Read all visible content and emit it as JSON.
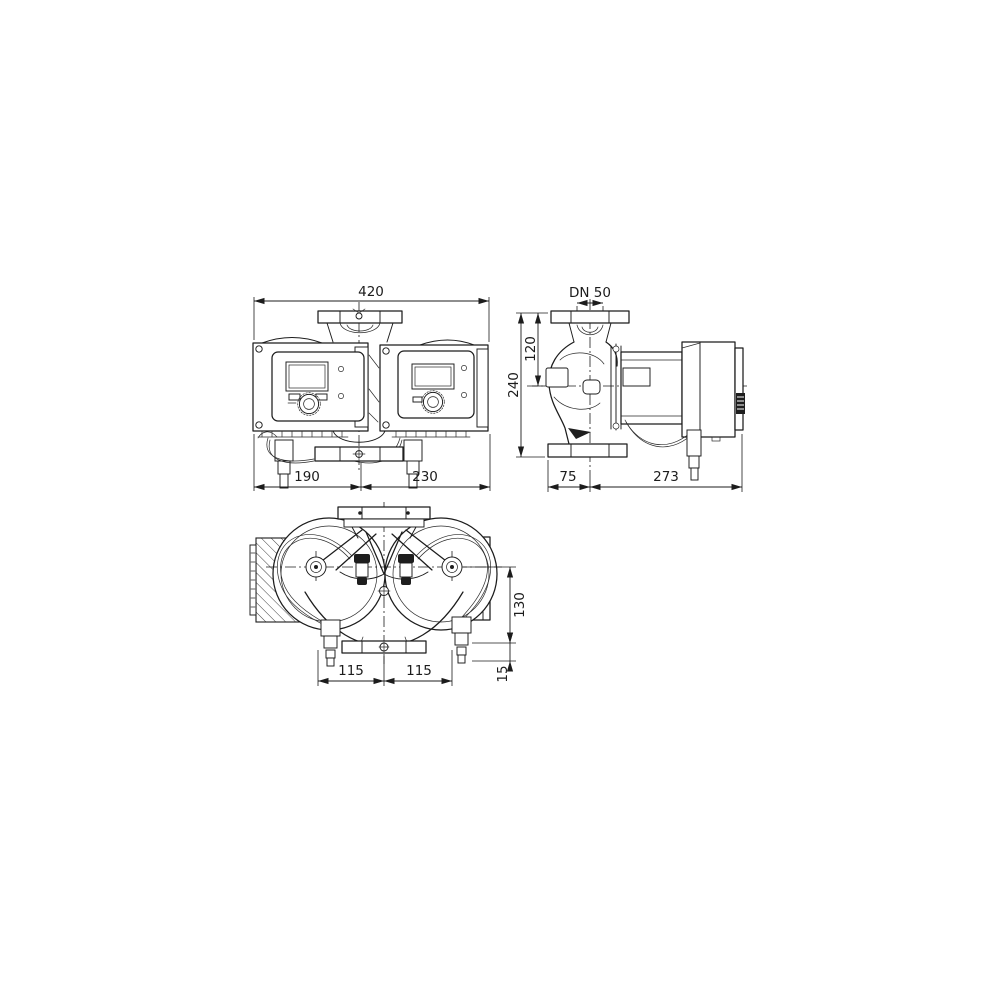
{
  "drawing": {
    "front_view": {
      "overall_width": "420",
      "left_width": "190",
      "right_width": "230"
    },
    "side_view": {
      "flange_dn": "DN 50",
      "center_height": "120",
      "total_height": "240",
      "front_depth": "75",
      "rear_depth": "273"
    },
    "plan_view": {
      "center_offset": "130",
      "base_offset": "15",
      "left_pitch": "115",
      "right_pitch": "115"
    }
  }
}
